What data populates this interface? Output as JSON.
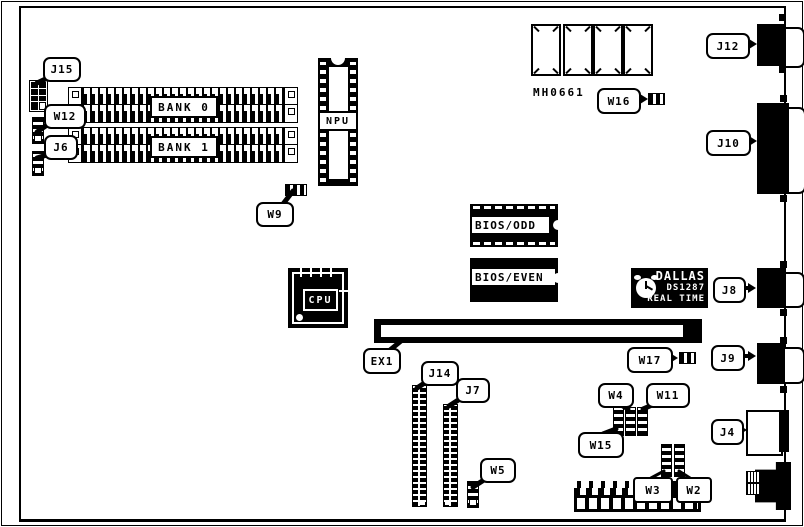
{
  "diagram": {
    "type": "motherboard-layout-diagram",
    "callouts": {
      "j15": "J15",
      "w12": "W12",
      "j6": "J6",
      "w9": "W9",
      "ex1": "EX1",
      "j14": "J14",
      "j7": "J7",
      "w5": "W5",
      "w4": "W4",
      "w11": "W11",
      "w15": "W15",
      "w3": "W3",
      "w2": "W2",
      "w16": "W16",
      "w17": "W17",
      "j12": "J12",
      "j10": "J10",
      "j8": "J8",
      "j9": "J9",
      "j4": "J4"
    },
    "chips": {
      "bank0": "BANK 0",
      "bank1": "BANK 1",
      "npu": "NPU",
      "cpu": "CPU",
      "bios_odd": "BIOS/ODD",
      "bios_even": "BIOS/EVEN",
      "mh": "MH0661",
      "dallas1": "DALLAS",
      "dallas2": "DS1287",
      "dallas3": "REAL TIME"
    },
    "colors": {
      "ink": "#000000",
      "paper": "#ffffff"
    }
  }
}
